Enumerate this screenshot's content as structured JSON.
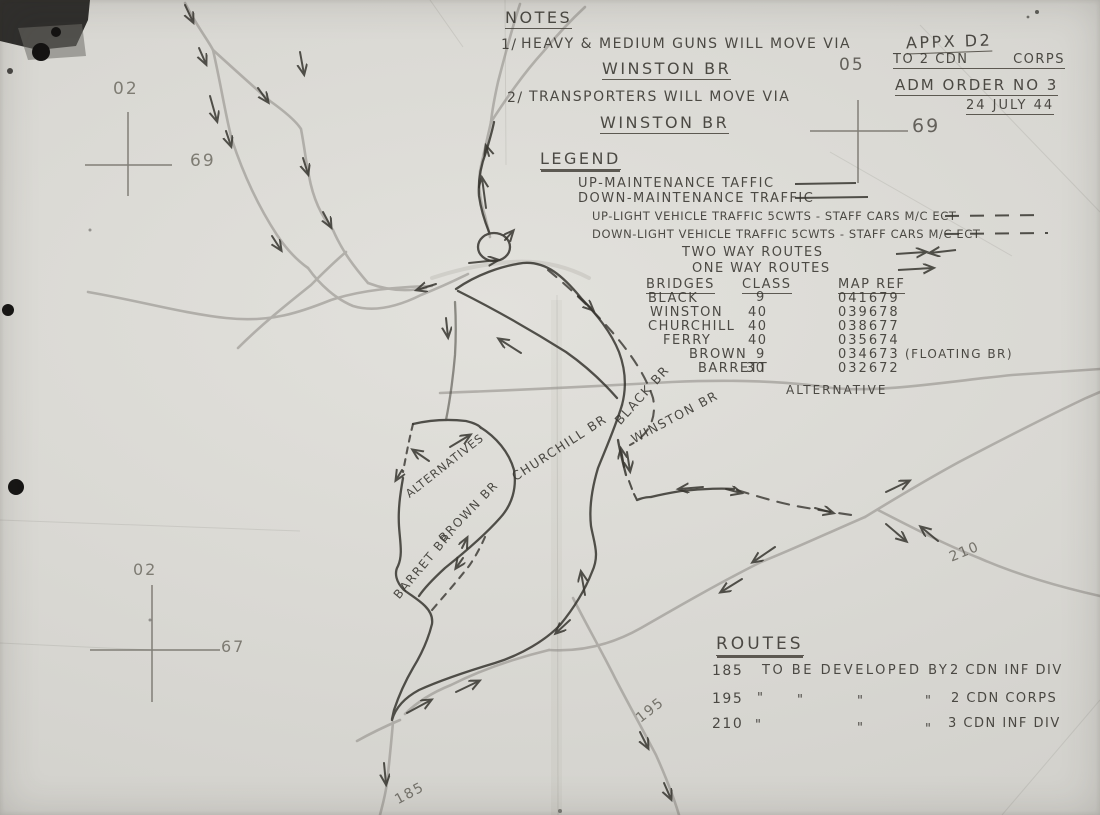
{
  "stamp": {
    "appx": "APPX D2",
    "to_left": "TO 2 CDN",
    "to_right": "CORPS",
    "order": "ADM ORDER NO 3",
    "date": "24 JULY 44"
  },
  "notes": {
    "title": "NOTES",
    "item1_num": "1/",
    "item1_text": "HEAVY & MEDIUM GUNS WILL MOVE VIA",
    "item1_via": "WINSTON BR",
    "item2_num": "2/",
    "item2_text": "TRANSPORTERS WILL MOVE VIA",
    "item2_via": "WINSTON BR"
  },
  "legend": {
    "title": "LEGEND",
    "row_up_maint": "UP-MAINTENANCE TAFFIC",
    "row_down_maint": "DOWN-MAINTENANCE TRAFFIC",
    "row_up_light": "UP-LIGHT VEHICLE TRAFFIC  5CWTS - STAFF CARS M/C ECT",
    "row_down_light": "DOWN-LIGHT VEHICLE TRAFFIC  5CWTS - STAFF CARS M/C ECT",
    "row_two_way": "TWO WAY ROUTES",
    "row_one_way": "ONE WAY ROUTES"
  },
  "bridges": {
    "h_name": "BRIDGES",
    "h_class": "CLASS",
    "h_ref": "MAP REF",
    "rows": [
      {
        "name": "BLACK",
        "cls": "9",
        "ref": "041679",
        "note": ""
      },
      {
        "name": "WINSTON",
        "cls": "40",
        "ref": "039678",
        "note": ""
      },
      {
        "name": "CHURCHILL",
        "cls": "40",
        "ref": "038677",
        "note": ""
      },
      {
        "name": "FERRY",
        "cls": "40",
        "ref": "035674",
        "note": ""
      },
      {
        "name": "BROWN",
        "cls": "9",
        "ref": "034673",
        "note": "(FLOATING BR)"
      },
      {
        "name": "BARRETT",
        "cls": "30",
        "ref": "032672",
        "note": ""
      }
    ]
  },
  "routes": {
    "title": "ROUTES",
    "ditto": "\"",
    "row1_num": "185",
    "row1_text": "TO BE DEVELOPED BY",
    "row1_unit": "2 CDN INF DIV",
    "row2_num": "195",
    "row2_unit": "2 CDN CORPS",
    "row3_num": "210",
    "row3_unit": "3 CDN INF DIV"
  },
  "grid": {
    "tl_easting": "02",
    "tl_northing": "69",
    "tr_easting": "05",
    "tr_northing": "69",
    "bl_easting": "02",
    "bl_northing": "67"
  },
  "map_labels": {
    "black_br": "BLACK BR",
    "winston_br": "WINSTON BR",
    "churchill_br": "CHURCHILL BR",
    "alternatives": "ALTERNATIVES",
    "brown_br": "BROWN BR",
    "barret_br": "BARRET BR.",
    "alternative": "ALTERNATIVE",
    "route_210": "210",
    "route_195": "195",
    "route_185": "185"
  }
}
